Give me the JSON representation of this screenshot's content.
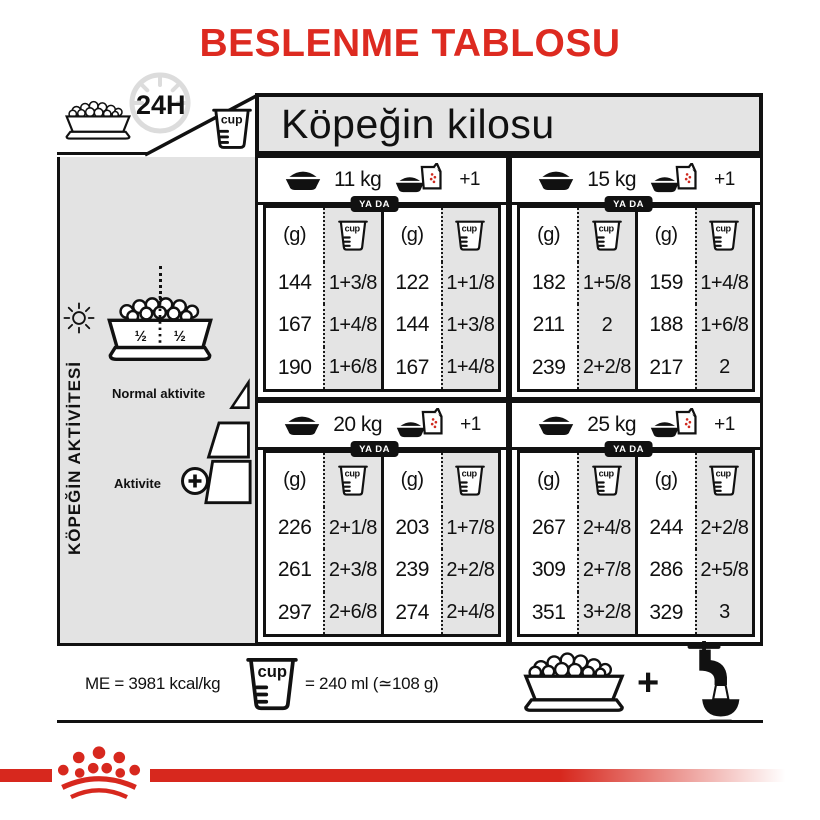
{
  "title": "BESLENME TABLOSU",
  "colors": {
    "red": "#dd2a20",
    "stripe_red": "#d7281e",
    "gray": "#e4e4e4"
  },
  "top": {
    "hours": "24H",
    "cup_label": "cup",
    "weight_header": "Köpeğin kilosu"
  },
  "sidebar": {
    "vertical_label": "KÖPEĞİN AKTİVİTESİ",
    "half_left": "½",
    "half_right": "½",
    "normal_activity_label": "Normal aktivite",
    "activity_label": "Aktivite",
    "plus": "+"
  },
  "table": {
    "g_unit": "(g)",
    "cup_label": "cup",
    "or_label": "YA DA",
    "plus_one": "+1",
    "sections": [
      {
        "weight": "11 kg",
        "dry": {
          "g": [
            "144",
            "167",
            "190"
          ],
          "cup": [
            "1+3/8",
            "1+4/8",
            "1+6/8"
          ]
        },
        "mixed": {
          "g": [
            "122",
            "144",
            "167"
          ],
          "cup": [
            "1+1/8",
            "1+3/8",
            "1+4/8"
          ]
        }
      },
      {
        "weight": "15 kg",
        "dry": {
          "g": [
            "182",
            "211",
            "239"
          ],
          "cup": [
            "1+5/8",
            "2",
            "2+2/8"
          ]
        },
        "mixed": {
          "g": [
            "159",
            "188",
            "217"
          ],
          "cup": [
            "1+4/8",
            "1+6/8",
            "2"
          ]
        }
      },
      {
        "weight": "20 kg",
        "dry": {
          "g": [
            "226",
            "261",
            "297"
          ],
          "cup": [
            "2+1/8",
            "2+3/8",
            "2+6/8"
          ]
        },
        "mixed": {
          "g": [
            "203",
            "239",
            "274"
          ],
          "cup": [
            "1+7/8",
            "2+2/8",
            "2+4/8"
          ]
        }
      },
      {
        "weight": "25 kg",
        "dry": {
          "g": [
            "267",
            "309",
            "351"
          ],
          "cup": [
            "2+4/8",
            "2+7/8",
            "3+2/8"
          ]
        },
        "mixed": {
          "g": [
            "244",
            "286",
            "329"
          ],
          "cup": [
            "2+2/8",
            "2+5/8",
            "3"
          ]
        }
      }
    ]
  },
  "footer": {
    "me": "ME = 3981 kcal/kg",
    "cup_label": "cup",
    "cup_equals": "= 240 ml (≃108 g)",
    "plus": "+"
  }
}
